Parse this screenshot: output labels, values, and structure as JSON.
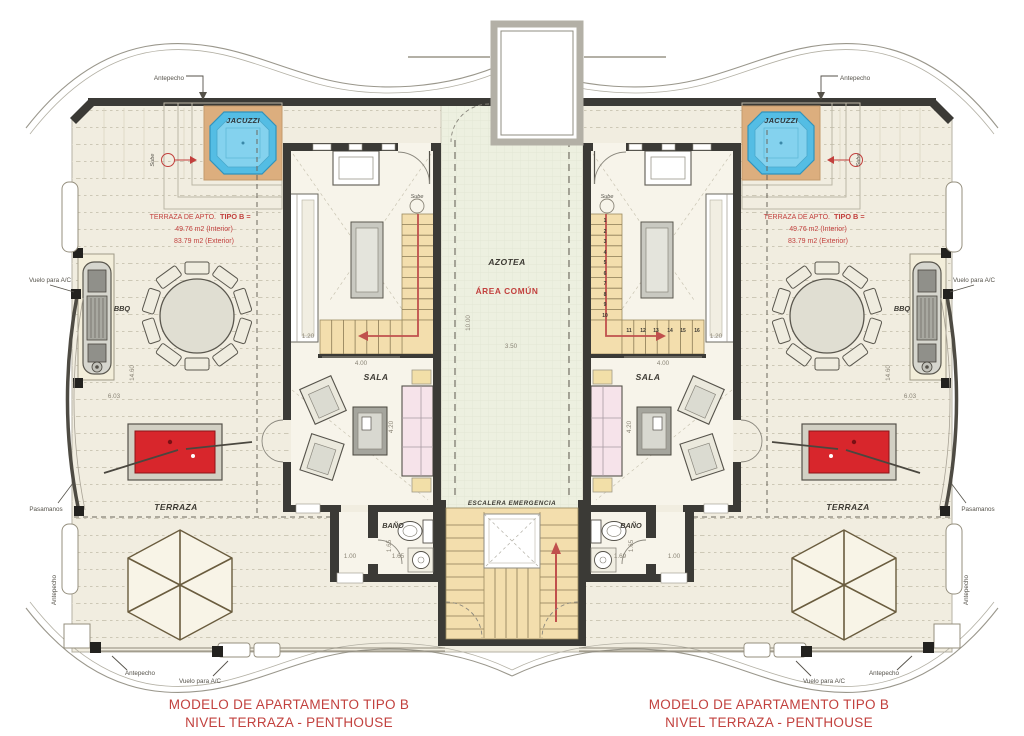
{
  "labels": {
    "jacuzzi": "JACUZZI",
    "terraza": "TERRAZA",
    "sala": "SALA",
    "bano": "BAÑO",
    "azotea": "AZOTEA",
    "area_comun": "ÁREA COMÚN",
    "escalera_emergencia": "ESCALERA EMERGENCIA",
    "bbq": "BBQ",
    "sube": "Sube",
    "antepecho": "Antepecho",
    "vuelo_ac": "Vuelo para A/C",
    "pasamanos": "Pasamanos"
  },
  "note": {
    "line1_normal": "TERRAZA DE APTO.",
    "line1_bold": "TIPO B =",
    "line2": "49.76 m2 (Interior)",
    "line3": "83.79 m2 (Exterior)"
  },
  "footer": {
    "line1": "MODELO DE APARTAMENTO TIPO B",
    "line2": "NIVEL TERRAZA - PENTHOUSE"
  },
  "dims": {
    "stair_width": "1.20",
    "sala_width": "4.00",
    "corridor_width": "3.50",
    "corridor_length": "10.00",
    "terrace_length": "14.60",
    "terrace_width": "6.03",
    "sala_depth": "4.20",
    "hall_width": "1.00",
    "bath_width": "1.65",
    "bath_width_alt": "1.69"
  },
  "stair_steps": [
    "1",
    "2",
    "3",
    "4",
    "5",
    "6",
    "7",
    "8",
    "9",
    "10",
    "11",
    "12",
    "13",
    "14",
    "15",
    "16"
  ],
  "colors": {
    "red_text": "#c2403d",
    "pool_table_red": "#d8262c",
    "jacuzzi_water": "#54bde4",
    "jacuzzi_inner": "#84d2ee",
    "jacuzzi_deck": "#dcae7e",
    "wall_dark": "#3b3a36",
    "terrace_floor": "#f1ede0",
    "stair_wood": "#f3dead",
    "sofa_pink": "#f6e3ea",
    "stair_path_red": "#c0504d"
  }
}
